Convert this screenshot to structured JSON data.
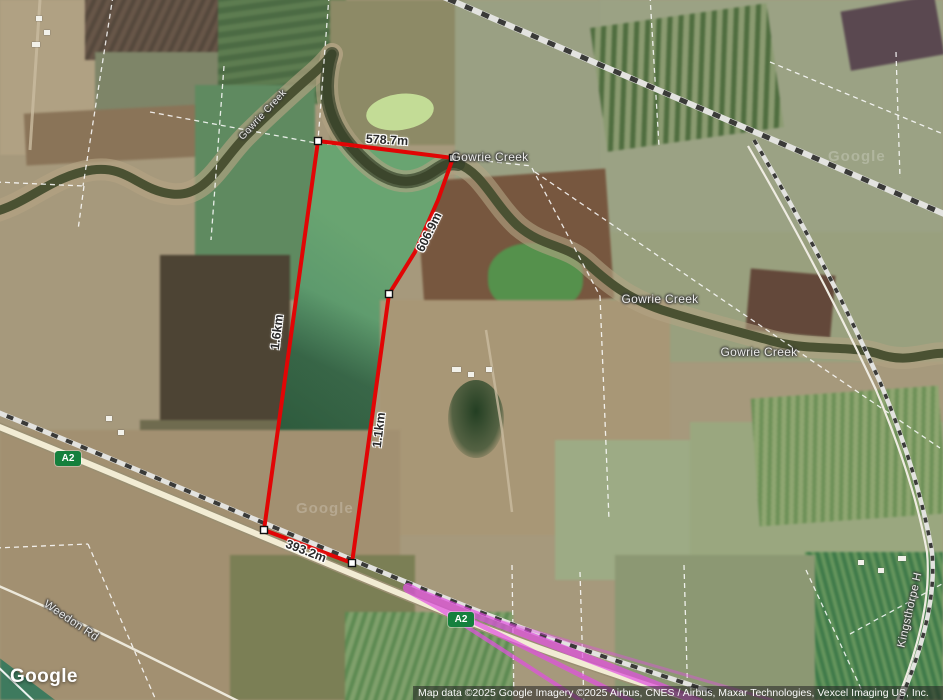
{
  "map": {
    "measurements": {
      "top": "578.7m",
      "upper_right": "606.9m",
      "left": "1.6km",
      "lower_right": "1.1km",
      "bottom": "393.2m"
    },
    "places": {
      "creek_label_1": "Gowrie Creek",
      "creek_label_2": "Gowrie Creek",
      "creek_label_3": "Gowrie Creek",
      "creek_label_small": "Gowrie Creek"
    },
    "roads": {
      "shield": "A2",
      "weedon": "Weedon Rd",
      "kingsthorpe": "Kingsthorpe H"
    },
    "watermarks": {
      "logo": "Google",
      "tile_1": "Google",
      "tile_2": "Google"
    }
  },
  "attribution": {
    "text": "Map data ©2025 Google Imagery ©2025 Airbus, CNES / Airbus, Maxar Technologies, Vexcel Imaging US, Inc."
  },
  "colors": {
    "polygon": "#e10505",
    "route_shield": "#15803d",
    "selection": "#e24fe2"
  }
}
